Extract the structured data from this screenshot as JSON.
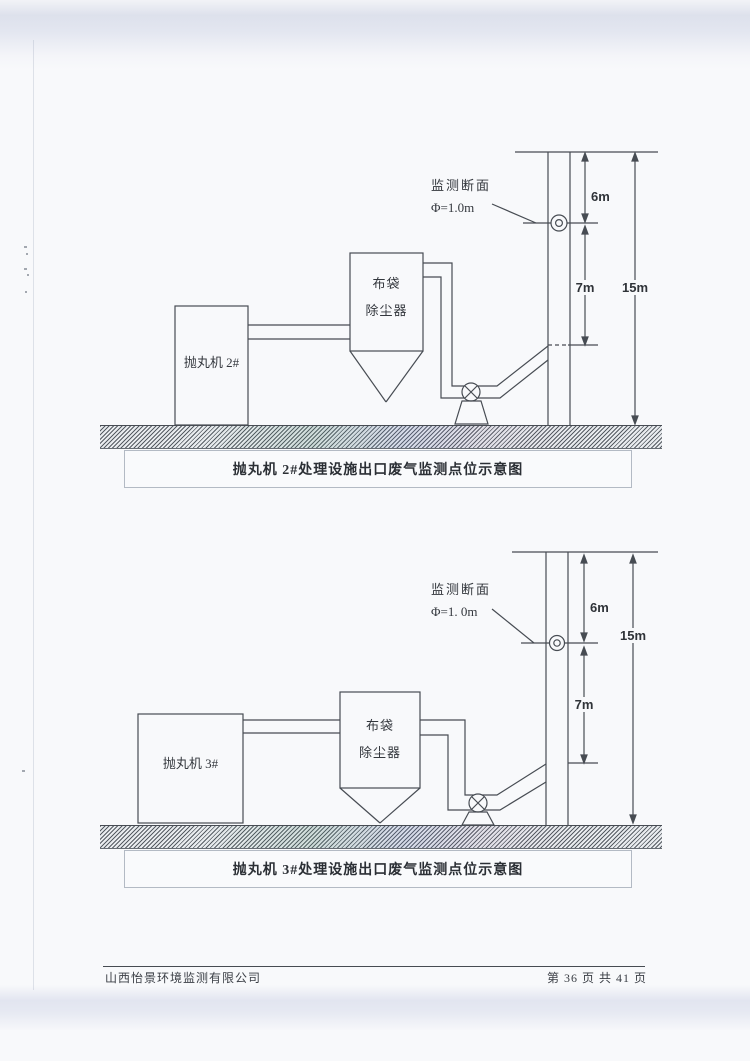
{
  "colors": {
    "ink": "#474c53",
    "paper": "#f8f9fb",
    "scan_band": "#dde1ec",
    "caption_border": "#b3bac4"
  },
  "diagram1": {
    "machine_label": "抛丸机 2#",
    "collector_label_line1": "布袋",
    "collector_label_line2": "除尘器",
    "section_label": "监测断面",
    "diameter_label": "Φ=1.0m",
    "dim_upper": "6m",
    "dim_lower": "7m",
    "dim_total": "15m",
    "caption": "抛丸机 2#处理设施出口废气监测点位示意图"
  },
  "diagram2": {
    "machine_label": "抛丸机 3#",
    "collector_label_line1": "布袋",
    "collector_label_line2": "除尘器",
    "section_label": "监测断面",
    "diameter_label": "Φ=1. 0m",
    "dim_upper": "6m",
    "dim_lower": "7m",
    "dim_total": "15m",
    "caption": "抛丸机 3#处理设施出口废气监测点位示意图"
  },
  "footer": {
    "company": "山西怡景环境监测有限公司",
    "page_info": "第 36 页 共 41 页"
  }
}
